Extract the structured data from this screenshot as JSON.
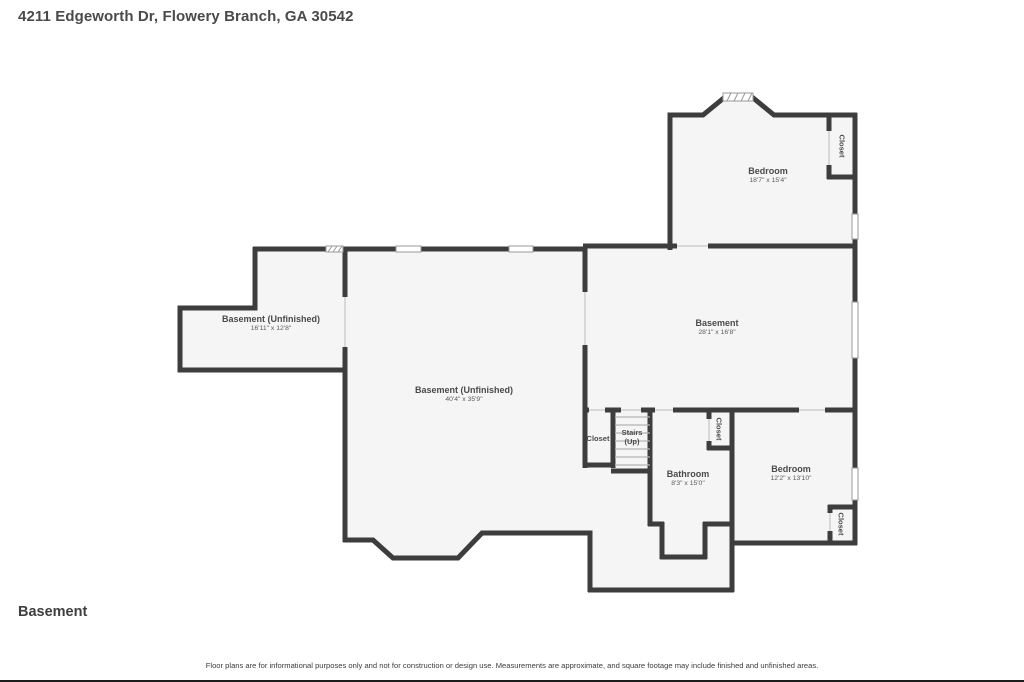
{
  "header": {
    "address": "4211 Edgeworth Dr, Flowery Branch, GA 30542"
  },
  "footer": {
    "floor_label": "Basement",
    "disclaimer": "Floor plans are for informational purposes only and not for construction or design use. Measurements are approximate, and square footage may include finished and unfinished areas."
  },
  "colors": {
    "wall": "#3d3d3d",
    "floor": "#f5f5f5",
    "text": "#4a4a4a"
  },
  "rooms": [
    {
      "name": "Bedroom",
      "dims": "18'7\" x 15'4\""
    },
    {
      "name": "Closet"
    },
    {
      "name": "Basement (Unfinished)",
      "dims": "16'11\" x 12'8\""
    },
    {
      "name": "Basement (Unfinished)",
      "dims": "40'4\" x 35'9\""
    },
    {
      "name": "Basement",
      "dims": "28'1\" x 16'8\""
    },
    {
      "name": "Closet"
    },
    {
      "name": "Stairs",
      "dims": "(Up)"
    },
    {
      "name": "Closet"
    },
    {
      "name": "Bathroom",
      "dims": "8'3\" x 15'0\""
    },
    {
      "name": "Bedroom",
      "dims": "12'2\" x 13'10\""
    },
    {
      "name": "Closet"
    }
  ]
}
